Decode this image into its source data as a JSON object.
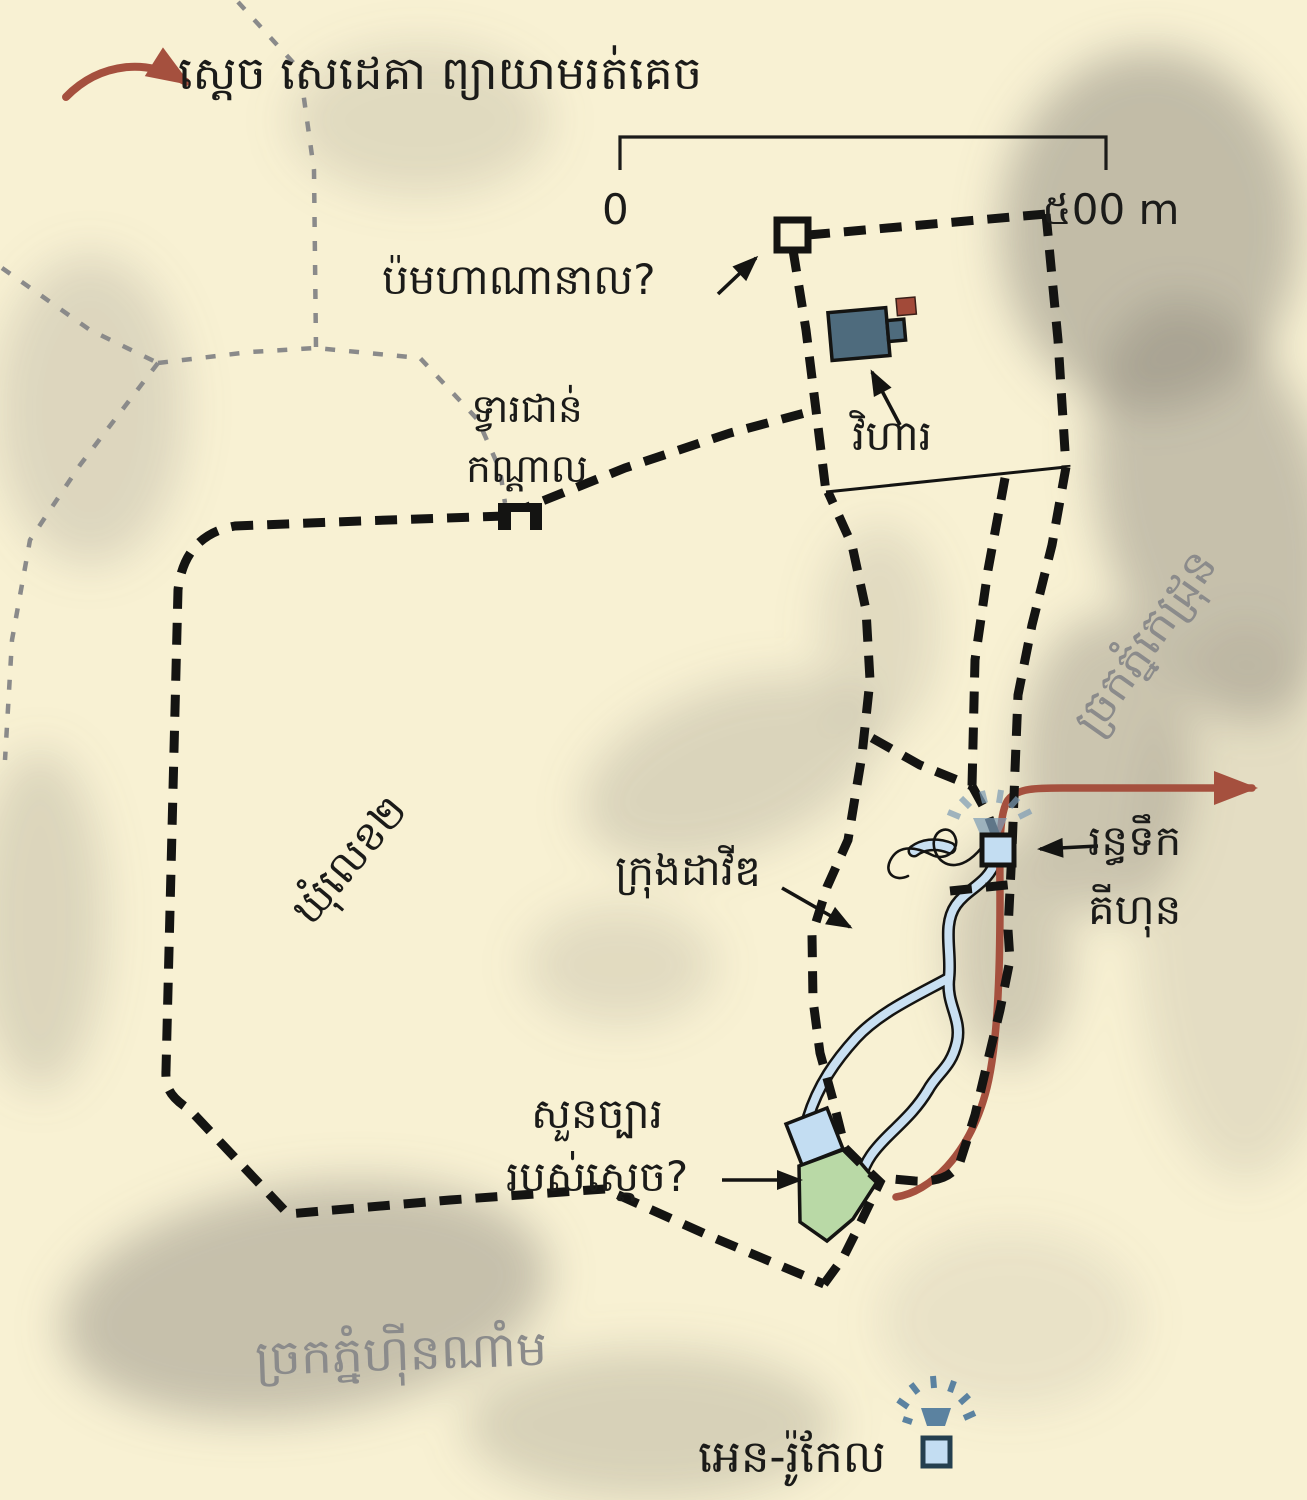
{
  "legend": {
    "text": "ស្ដេច សេដេគា ព្យាយាមរត់គេច"
  },
  "scale_bar": {
    "start": "0",
    "end": "៥00 m"
  },
  "labels": {
    "tower": "ប៉មហាណានាល?",
    "middle_gate": [
      "ទ្វារជាន់",
      "កណ្ដាល"
    ],
    "temple": "វិហារ",
    "second_quarter": "ឃុំលេខ២",
    "city_of_david": "ក្រុងដាវីឌ",
    "gihon_spring": [
      "រន្ធទឹក",
      "គីហុន"
    ],
    "kings_garden": [
      "សួនច្បារ",
      "របស់ស្ដេច?"
    ],
    "kidron_valley": "ច្រកភ្នំកេដ្រុន",
    "hinnom_valley": "ច្រកភ្នំហ៊ីនណាំម",
    "en_rogel": "អេន-រ៉ូកែល"
  },
  "colors": {
    "paper": "#f8f1d3",
    "ink": "#141412",
    "label": "#1b1b19",
    "valley_label": "#8b8b8b",
    "road": "#8a8a8a",
    "route": "#a5503e",
    "water_fill": "#c9e0f2",
    "pool_fill": "#c3ddf2",
    "garden_fill": "#b9d9a6",
    "building": "#4e6b7d",
    "altar": "#a24a39",
    "spring": "#5b82a0",
    "spring_faded": "#7d9cb5",
    "terrain": "#8c877c"
  }
}
